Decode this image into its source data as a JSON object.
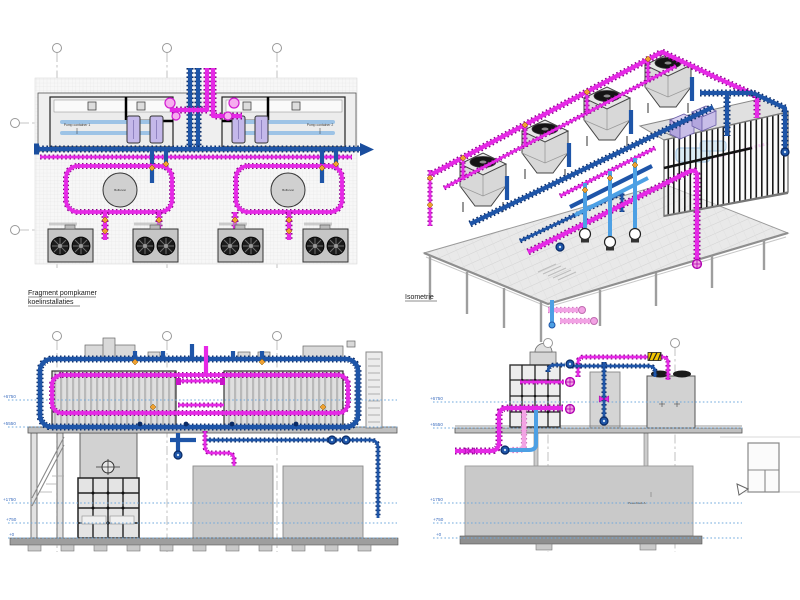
{
  "drawing": {
    "captions": {
      "section_left_line1": "Fragment pompkamer",
      "section_left_line2": "koelinstallaties",
      "isometric": "Isometrie"
    },
    "plan": {
      "container1_label": "Pomp container 1",
      "container2_label": "Pomp container 2",
      "buffer_label": "Buffervat"
    },
    "sections": {
      "levels": [
        "+6750",
        "+5550",
        "+1750",
        "+750",
        "+0"
      ],
      "powerblock_label": "Powerblock A"
    },
    "colors": {
      "pipe_magenta": "#E629E6",
      "pipe_dark_blue": "#1E55A8",
      "pipe_light_blue": "#4DA0E4",
      "pipe_pink": "#F2A3E4",
      "valve_orange": "#F0A030",
      "equipment_gray": "#C9C9C9",
      "level_line_blue": "#6FA8DC"
    }
  }
}
